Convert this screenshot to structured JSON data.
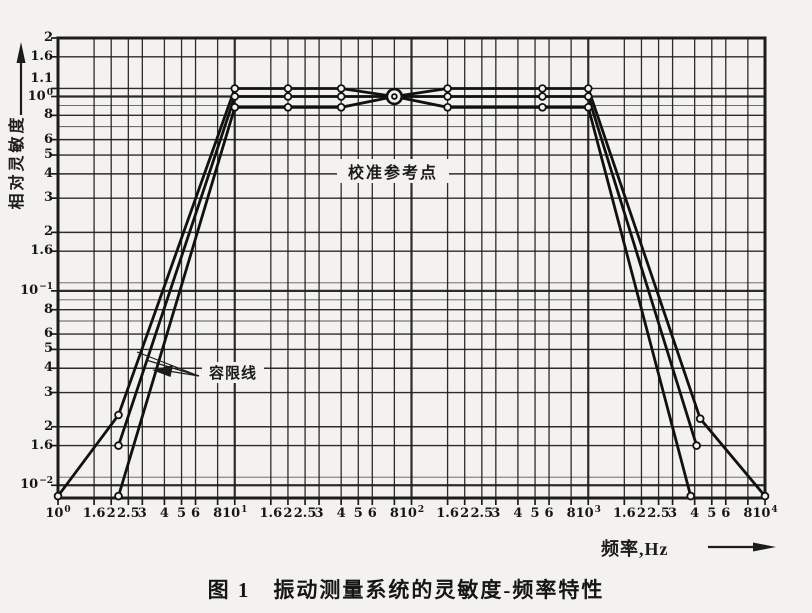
{
  "figure": {
    "caption": "图 1　振动测量系统的灵敏度-频率特性",
    "y_axis_title": "相对灵敏度",
    "x_axis_title": "频率,Hz",
    "calibration_label": "校准参考点",
    "tolerance_label": "容限线",
    "ink_color": "#1c1c1c",
    "paper_color": "#f3f2ee"
  },
  "chart_data": {
    "type": "line",
    "title": "振动测量系统的灵敏度-频率特性",
    "xlabel": "频率,Hz",
    "ylabel": "相对灵敏度",
    "x_scale": "log",
    "y_scale": "log",
    "x_range": [
      1,
      10000
    ],
    "y_range": [
      0.0086,
      2.0
    ],
    "grid": true,
    "x_ticks": [
      {
        "v": 1,
        "label": "10^0"
      },
      {
        "v": 1.6,
        "label": "1.6"
      },
      {
        "v": 2,
        "label": "2"
      },
      {
        "v": 2.5,
        "label": "2.5"
      },
      {
        "v": 3,
        "label": "3"
      },
      {
        "v": 4,
        "label": "4"
      },
      {
        "v": 5,
        "label": "5"
      },
      {
        "v": 6,
        "label": "6"
      },
      {
        "v": 8,
        "label": "8"
      },
      {
        "v": 10,
        "label": "10^1"
      },
      {
        "v": 16,
        "label": "1.6"
      },
      {
        "v": 20,
        "label": "2"
      },
      {
        "v": 25,
        "label": "2.5"
      },
      {
        "v": 30,
        "label": "3"
      },
      {
        "v": 40,
        "label": "4"
      },
      {
        "v": 50,
        "label": "5"
      },
      {
        "v": 60,
        "label": "6"
      },
      {
        "v": 80,
        "label": "8"
      },
      {
        "v": 100,
        "label": "10^2"
      },
      {
        "v": 160,
        "label": "1.6"
      },
      {
        "v": 200,
        "label": "2"
      },
      {
        "v": 250,
        "label": "2.5"
      },
      {
        "v": 300,
        "label": "3"
      },
      {
        "v": 400,
        "label": "4"
      },
      {
        "v": 500,
        "label": "5"
      },
      {
        "v": 600,
        "label": "6"
      },
      {
        "v": 800,
        "label": "8"
      },
      {
        "v": 1000,
        "label": "10^3"
      },
      {
        "v": 1600,
        "label": "1.6"
      },
      {
        "v": 2000,
        "label": "2"
      },
      {
        "v": 2500,
        "label": "2.5"
      },
      {
        "v": 3000,
        "label": "3"
      },
      {
        "v": 4000,
        "label": "4"
      },
      {
        "v": 5000,
        "label": "5"
      },
      {
        "v": 6000,
        "label": "6"
      },
      {
        "v": 8000,
        "label": "8"
      },
      {
        "v": 10000,
        "label": "10^4"
      }
    ],
    "y_ticks": [
      {
        "v": 2,
        "label": "2"
      },
      {
        "v": 1.6,
        "label": "1.6"
      },
      {
        "v": 1.1,
        "label": "1.1"
      },
      {
        "v": 1,
        "label": "10^0"
      },
      {
        "v": 0.8,
        "label": "8"
      },
      {
        "v": 0.6,
        "label": "6"
      },
      {
        "v": 0.5,
        "label": "5"
      },
      {
        "v": 0.4,
        "label": "4"
      },
      {
        "v": 0.3,
        "label": "3"
      },
      {
        "v": 0.2,
        "label": "2"
      },
      {
        "v": 0.16,
        "label": "1.6"
      },
      {
        "v": 0.1,
        "label": "10^-1"
      },
      {
        "v": 0.08,
        "label": "8"
      },
      {
        "v": 0.06,
        "label": "6"
      },
      {
        "v": 0.05,
        "label": "5"
      },
      {
        "v": 0.04,
        "label": "4"
      },
      {
        "v": 0.03,
        "label": "3"
      },
      {
        "v": 0.02,
        "label": "2"
      },
      {
        "v": 0.016,
        "label": "1.6"
      },
      {
        "v": 0.01,
        "label": "10^-2"
      }
    ],
    "y_minor_lines": [
      0.9,
      0.7,
      0.11,
      0.09,
      0.07,
      0.011
    ],
    "series": [
      {
        "name": "tolerance-upper",
        "points": [
          [
            1,
            0.0088
          ],
          [
            2.2,
            0.023
          ],
          [
            10,
            1.1
          ],
          [
            40,
            1.1
          ],
          [
            80,
            1.0
          ],
          [
            160,
            1.1
          ],
          [
            1000,
            1.1
          ],
          [
            4300,
            0.022
          ],
          [
            10000,
            0.0088
          ]
        ],
        "markers": [
          [
            1,
            0.0088
          ],
          [
            2.2,
            0.023
          ],
          [
            10,
            1.1
          ],
          [
            20,
            1.1
          ],
          [
            40,
            1.1
          ],
          [
            160,
            1.1
          ],
          [
            550,
            1.1
          ],
          [
            1000,
            1.1
          ],
          [
            4300,
            0.022
          ],
          [
            10000,
            0.0088
          ]
        ]
      },
      {
        "name": "nominal",
        "points": [
          [
            2.2,
            0.016
          ],
          [
            10,
            1.0
          ],
          [
            1000,
            1.0
          ],
          [
            4100,
            0.016
          ]
        ],
        "markers": [
          [
            2.2,
            0.016
          ],
          [
            10,
            1.0
          ],
          [
            20,
            1.0
          ],
          [
            40,
            1.0
          ],
          [
            160,
            1.0
          ],
          [
            550,
            1.0
          ],
          [
            1000,
            1.0
          ],
          [
            4100,
            0.016
          ]
        ]
      },
      {
        "name": "tolerance-lower",
        "points": [
          [
            2.2,
            0.0088
          ],
          [
            10,
            0.88
          ],
          [
            40,
            0.88
          ],
          [
            80,
            1.0
          ],
          [
            160,
            0.88
          ],
          [
            1000,
            0.88
          ],
          [
            3800,
            0.0088
          ]
        ],
        "markers": [
          [
            2.2,
            0.0088
          ],
          [
            10,
            0.88
          ],
          [
            20,
            0.88
          ],
          [
            40,
            0.88
          ],
          [
            160,
            0.88
          ],
          [
            550,
            0.88
          ],
          [
            1000,
            0.88
          ],
          [
            3800,
            0.0088
          ]
        ]
      }
    ],
    "calibration_point": {
      "f": 80,
      "v": 1.0,
      "label": "校准参考点"
    }
  }
}
